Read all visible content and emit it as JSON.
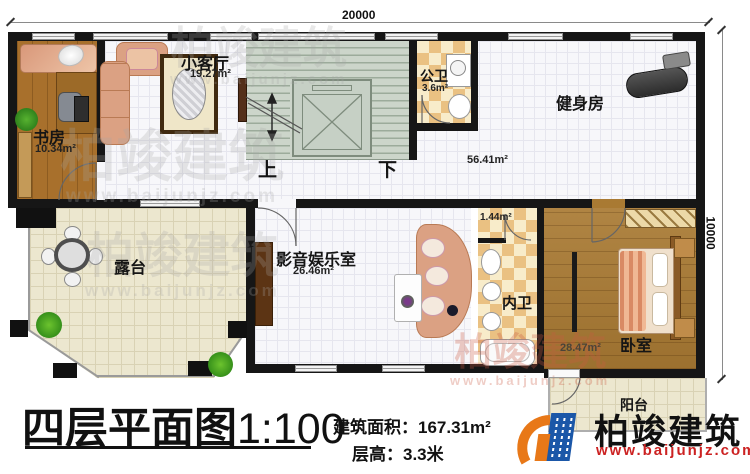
{
  "dims": {
    "top": "20000",
    "right": "10000"
  },
  "rooms": {
    "study": {
      "name": "书房",
      "area": "10.34m²"
    },
    "living": {
      "name": "小客厅",
      "area": "19.27m²"
    },
    "public_bath": {
      "name": "公卫",
      "area": "3.6m²"
    },
    "gym": {
      "name": "健身房",
      "area": "56.41m²"
    },
    "terrace": {
      "name": "露台"
    },
    "media": {
      "name": "影音娱乐室",
      "area": "26.46m²"
    },
    "closet": {
      "area": "1.44m²"
    },
    "inner_bath": {
      "name": "内卫"
    },
    "bedroom": {
      "name": "卧室",
      "area": "28.47m²"
    },
    "balcony": {
      "name": "阳台"
    }
  },
  "stairs": {
    "up_label": "上",
    "down_label": "下"
  },
  "title": {
    "main": "四层平面图",
    "scale": "1:100",
    "area_label": "建筑面积：",
    "area_value": "167.31m²",
    "floor_height_label": "层高：",
    "floor_height_value": "3.3米"
  },
  "brand": {
    "name": "柏竣建筑",
    "url": "www.baijunjz.com"
  },
  "watermark": {
    "name": "柏竣建筑",
    "url": "www.baijunjz.com"
  },
  "colors": {
    "wall": "#161616",
    "wood": "#a97a33",
    "checker_tile": "#eac182",
    "stairs": "#ccd5ca",
    "terrace": "#ece7cf",
    "brand_blue": "#1b57a8",
    "brand_orange": "#e87818",
    "brand_red": "#cc2222"
  }
}
